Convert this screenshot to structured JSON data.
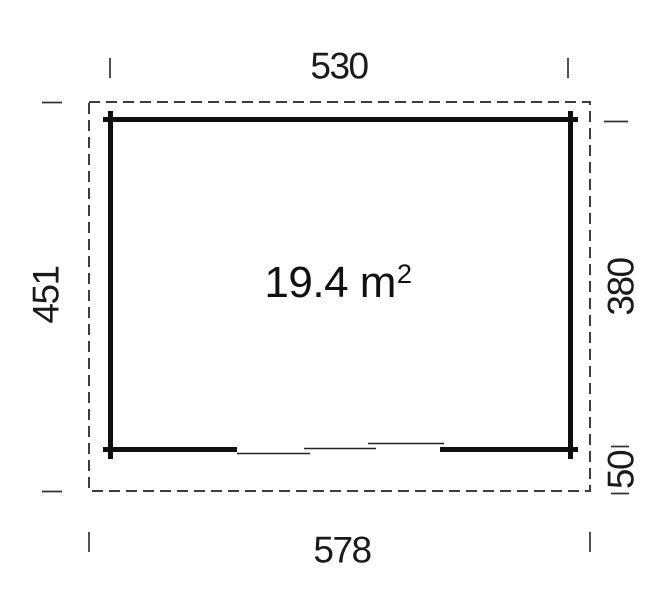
{
  "drawing": {
    "type": "floor-plan",
    "area_label": {
      "value": "19.4 m",
      "superscript": "2"
    },
    "dimensions": {
      "top_width": "530",
      "bottom_total_width": "578",
      "left_total_depth": "451",
      "right_inner_depth": "380",
      "right_front_depth": "50"
    },
    "colors": {
      "background": "#ffffff",
      "wall": "#0f0f0f",
      "thin_line": "#222222",
      "dashed_boundary": "#3d3d3d",
      "tick": "#333333",
      "text": "#1a1a1a"
    }
  }
}
